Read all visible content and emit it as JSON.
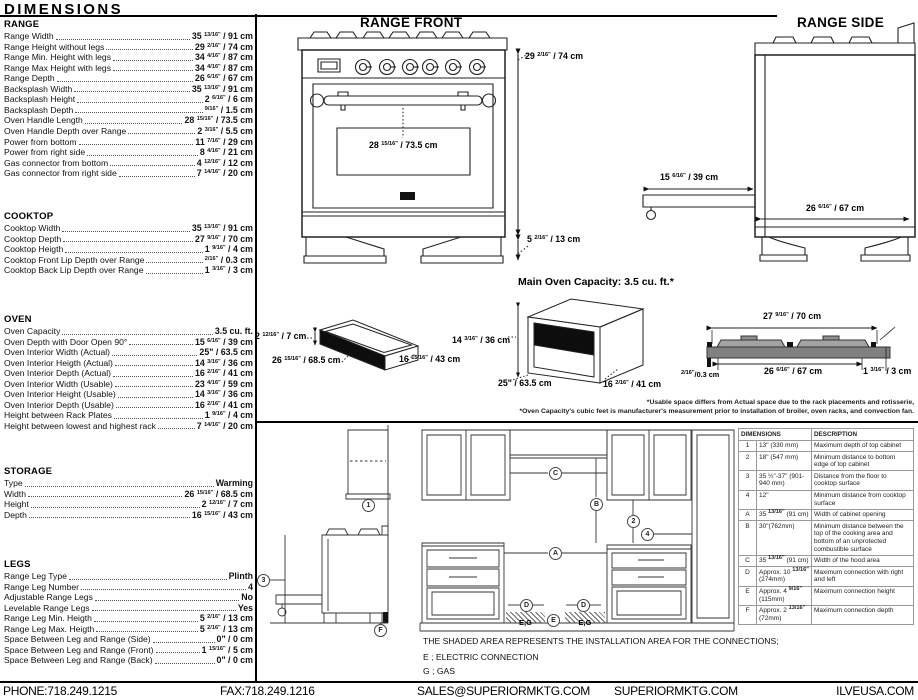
{
  "title": "DIMENSIONS",
  "spec_sections": [
    {
      "title": "RANGE",
      "rows": [
        {
          "label": "Range Width",
          "value": "35 13/16\" / 91 cm"
        },
        {
          "label": "Range Height without legs",
          "value": "29 2/16\" / 74 cm"
        },
        {
          "label": "Range Min. Height with legs",
          "value": "34 4/16\" / 87 cm"
        },
        {
          "label": "Range Max Height with legs",
          "value": "34 4/16\" / 87 cm"
        },
        {
          "label": "Range Depth",
          "value": "26 6/16\" / 67 cm"
        },
        {
          "label": "Backsplash Width",
          "value": "35 13/16\" / 91 cm"
        },
        {
          "label": "Backsplash Height",
          "value": "2 6/16\" / 6 cm"
        },
        {
          "label": "Backsplash Depth",
          "value": "9/16\" / 1.5 cm"
        },
        {
          "label": "Oven Handle Length",
          "value": "28 15/16\" / 73.5 cm"
        },
        {
          "label": "Oven Handle Depth over Range",
          "value": "2 3/16\" / 5.5 cm"
        },
        {
          "label": "Power from bottom",
          "value": "11 7/16\" / 29 cm"
        },
        {
          "label": "Power from right side",
          "value": "8 4/16\" / 21 cm"
        },
        {
          "label": "Gas connector from bottom",
          "value": "4 12/16\" / 12 cm"
        },
        {
          "label": "Gas connector from right side",
          "value": "7 14/16\" / 20 cm"
        }
      ]
    },
    {
      "title": "COOKTOP",
      "rows": [
        {
          "label": "Cooktop Width",
          "value": "35 13/16\" / 91 cm"
        },
        {
          "label": "Cooktop Depth",
          "value": "27 9/16\" / 70 cm"
        },
        {
          "label": "Cooktop Heigth",
          "value": "1 9/16\" / 4 cm"
        },
        {
          "label": "Cooktop Front Lip Depth over Range",
          "value": "2/16\" / 0.3 cm"
        },
        {
          "label": "Cooktop Back Lip Depth over Range",
          "value": "1 3/16\" / 3 cm"
        }
      ]
    },
    {
      "title": "OVEN",
      "rows": [
        {
          "label": "Oven Capacity",
          "value": "3.5 cu. ft."
        },
        {
          "label": "Oven Depth with Door Open 90°",
          "value": "15 6/16\" / 39 cm"
        },
        {
          "label": "Oven Interior Width (Actual)",
          "value": "25\" / 63.5 cm"
        },
        {
          "label": "Oven Interior Heigth (Actual)",
          "value": "14 3/16\" / 36 cm"
        },
        {
          "label": "Oven Interior Depth (Actual)",
          "value": "16 2/16\" / 41 cm"
        },
        {
          "label": "Oven Interior Width (Usable)",
          "value": "23 4/16\" / 59 cm"
        },
        {
          "label": "Oven Interior Height (Usable)",
          "value": "14 3/16\" / 36 cm"
        },
        {
          "label": "Oven Interior Depth (Usable)",
          "value": "16 2/16\" / 41 cm"
        },
        {
          "label": "Height between Rack Plates",
          "value": "1 9/16\" / 4 cm"
        },
        {
          "label": "Height between lowest and highest rack",
          "value": "7 14/16\" / 20 cm"
        }
      ]
    },
    {
      "title": "STORAGE",
      "rows": [
        {
          "label": "Type",
          "value": "Warming"
        },
        {
          "label": "Width",
          "value": "26 15/16\" / 68.5 cm"
        },
        {
          "label": "Height",
          "value": "2 12/16\" / 7 cm"
        },
        {
          "label": "Depth",
          "value": "16 15/16\" / 43 cm"
        }
      ]
    },
    {
      "title": "LEGS",
      "rows": [
        {
          "label": "Range Leg Type",
          "value": "Plinth"
        },
        {
          "label": "Range Leg Number",
          "value": "4"
        },
        {
          "label": "Adjustable Range Legs",
          "value": "No"
        },
        {
          "label": "Levelable Range Legs",
          "value": "Yes"
        },
        {
          "label": "Range Leg Min. Heigth",
          "value": "5 2/16\" / 13 cm"
        },
        {
          "label": "Range Leg Max. Heigth",
          "value": "5 2/16\" / 13 cm"
        },
        {
          "label": "Space Between Leg and Range (Side)",
          "value": "0\" / 0 cm"
        },
        {
          "label": "Space Between Leg and Range (Front)",
          "value": "1 15/16\" / 5 cm"
        },
        {
          "label": "Space Between Leg and Range (Back)",
          "value": "0\" / 0 cm"
        }
      ]
    }
  ],
  "diagrams": {
    "front": {
      "title": "RANGE FRONT",
      "height": "29 2/16\" / 74 cm",
      "handle_length": "28 15/16\" / 73.5 cm",
      "leg_height": "5 2/16\" / 13 cm"
    },
    "side": {
      "title": "RANGE SIDE",
      "door_open_depth": "15 6/16\" / 39 cm",
      "depth": "26 6/16\" / 67 cm"
    },
    "capacity_note": "Main Oven Capacity: 3.5 cu. ft.*",
    "drawer": {
      "height": "2 12/16\" / 7 cm",
      "width": "26 15/16\" / 68.5 cm",
      "depth": "16 15/16\" / 43 cm"
    },
    "oven_box": {
      "height": "14 3/16\" / 36 cm",
      "width": "25\" / 63.5 cm",
      "depth": "16 2/16\" / 41 cm"
    },
    "cooktop_profile": {
      "top_width": "27 9/16\" / 70 cm",
      "inner_width": "26 6/16\" / 67 cm",
      "front_lip": "2/16\"/0.3 cm",
      "back_lip": "1 3/16\" / 3 cm"
    },
    "footnotes": [
      "*Usable space differs from Actual space due to the rack placements and rotisserie,",
      "*Oven Capacity's cubic feet is manufacturer's measurement prior to installation of broiler, oven racks, and convection fan."
    ]
  },
  "installation": {
    "note": "THE SHADED AREA REPRESENTS THE INSTALLATION AREA FOR THE CONNECTIONS;",
    "legend": [
      "E ; ELECTRIC CONNECTION",
      "G ; GAS"
    ],
    "shaded_label": "E,G",
    "markers": {
      "r1": "1",
      "r2": "2",
      "r3": "3",
      "r4": "4",
      "rA": "A",
      "rB": "B",
      "rC": "C",
      "rD": "D",
      "rE": "E",
      "rF": "F"
    }
  },
  "table": {
    "headers": [
      "DIMENSIONS",
      "DESCRIPTION"
    ],
    "rows": [
      {
        "ref": "1",
        "dim": "13\" (330 mm)",
        "desc": "Maximum depth of top cabinet"
      },
      {
        "ref": "2",
        "dim": "18\" (547 mm)",
        "desc": "Minimum distance to bottom edge of top cabinet"
      },
      {
        "ref": "3",
        "dim": "35 ½\"-37\" (901-940 mm)",
        "desc": "Distance from the floor to cooktop surface"
      },
      {
        "ref": "4",
        "dim": "12\"",
        "desc": "Minimum distance from cooktop surface"
      },
      {
        "ref": "A",
        "dim": "35 13/16\" (91 cm)",
        "desc": "Width of cabinet opening"
      },
      {
        "ref": "B",
        "dim": "30\"(762mm)",
        "desc": "Minimum distance between the top of the cooking area and bottom of an unprotected combustible surface"
      },
      {
        "ref": "C",
        "dim": "35 13/16\" (91 cm)",
        "desc": "Width of the hood area"
      },
      {
        "ref": "D",
        "dim": "Approx. 10 13/16\" (274mm)",
        "desc": "Maximum connection with right and left"
      },
      {
        "ref": "E",
        "dim": "Approx. 4 9/16\" (115mm)",
        "desc": "Maximum connection height"
      },
      {
        "ref": "F",
        "dim": "Approx. 2 13/16\" (72mm)",
        "desc": "Maximum connection depth"
      }
    ]
  },
  "footer": {
    "items": [
      "PHONE:718.249.1215",
      "FAX:718.249.1216",
      "SALES@SUPERIORMKTG.COM",
      "SUPERIORMKTG.COM",
      "ILVEUSA.COM"
    ]
  }
}
